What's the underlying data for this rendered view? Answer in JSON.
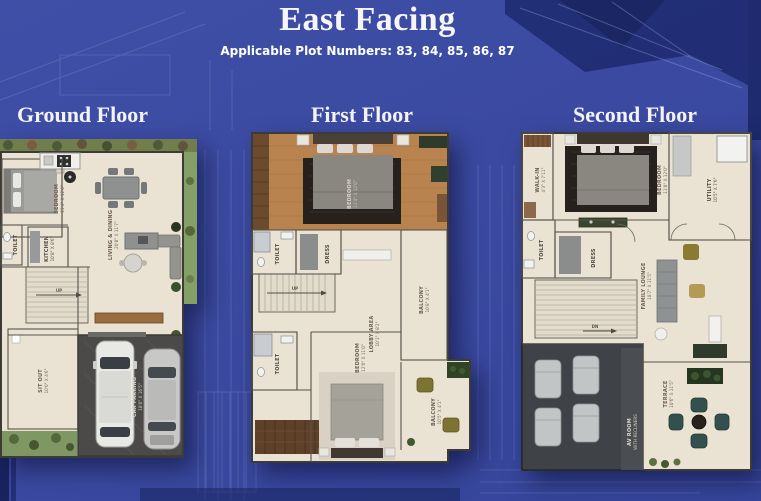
{
  "header": {
    "title": "East Facing",
    "subtitle": "Applicable Plot Numbers: 83, 84, 85, 86, 87"
  },
  "floors": {
    "ground": {
      "label": "Ground Floor",
      "rooms": {
        "bedroom": {
          "name": "BEDROOM",
          "dims": "11'4\" X 12'0\""
        },
        "living_dining": {
          "name": "LIVING & DINING",
          "dims": "20'8\" X 11'7\""
        },
        "kitchen": {
          "name": "KITCHEN",
          "dims": "10'8\" X 8'6\""
        },
        "toilet": {
          "name": "TOILET"
        },
        "sitout": {
          "name": "SIT OUT",
          "dims": "10'0\" X 4'6\""
        },
        "car_parking": {
          "name": "CAR PARKING",
          "dims": "18'0\" X 16'5\""
        },
        "stairs": {
          "name": "UP"
        }
      }
    },
    "first": {
      "label": "First Floor",
      "rooms": {
        "bedroom_top": {
          "name": "BEDROOM",
          "dims": "11'4\" X 12'0\""
        },
        "dress": {
          "name": "DRESS"
        },
        "toilet": {
          "name": "TOILET"
        },
        "lobby": {
          "name": "LOBBY AREA",
          "dims": "10'1\" X 8'2\""
        },
        "balcony_side": {
          "name": "BALCONY",
          "dims": "10'8\" X 4'1\""
        },
        "bedroom_bottom": {
          "name": "BEDROOM",
          "dims": "12'0\" X 11'0\""
        },
        "balcony_bottom": {
          "name": "BALCONY",
          "dims": "10'5\" X 4'1\""
        },
        "stairs": {
          "name": "UP"
        }
      }
    },
    "second": {
      "label": "Second Floor",
      "rooms": {
        "walk_in": {
          "name": "WALK-IN",
          "dims": "4'3\" X 7'11\""
        },
        "bedroom": {
          "name": "BEDROOM",
          "dims": "11'8\" X 12'0\""
        },
        "utility": {
          "name": "UTILITY",
          "dims": "10'5\" X 7'6\""
        },
        "toilet": {
          "name": "TOILET"
        },
        "dress": {
          "name": "DRESS"
        },
        "family_lounge": {
          "name": "FAMILY LOUNGE",
          "dims": "18'7\" X 11'5\""
        },
        "av_room": {
          "name": "AV ROOM",
          "dims": "WITH RECLINERS"
        },
        "terrace": {
          "name": "TERRACE",
          "dims": "10'6\" X 11'5\""
        },
        "stairs": {
          "name": "DN"
        }
      }
    }
  },
  "colors": {
    "background": "#3b4aa0",
    "dark_navy": "#1d2a6e",
    "blueprint_line": "#c7d2f2",
    "panel_floor": "#eae2d3",
    "wood": "#b8834e"
  }
}
